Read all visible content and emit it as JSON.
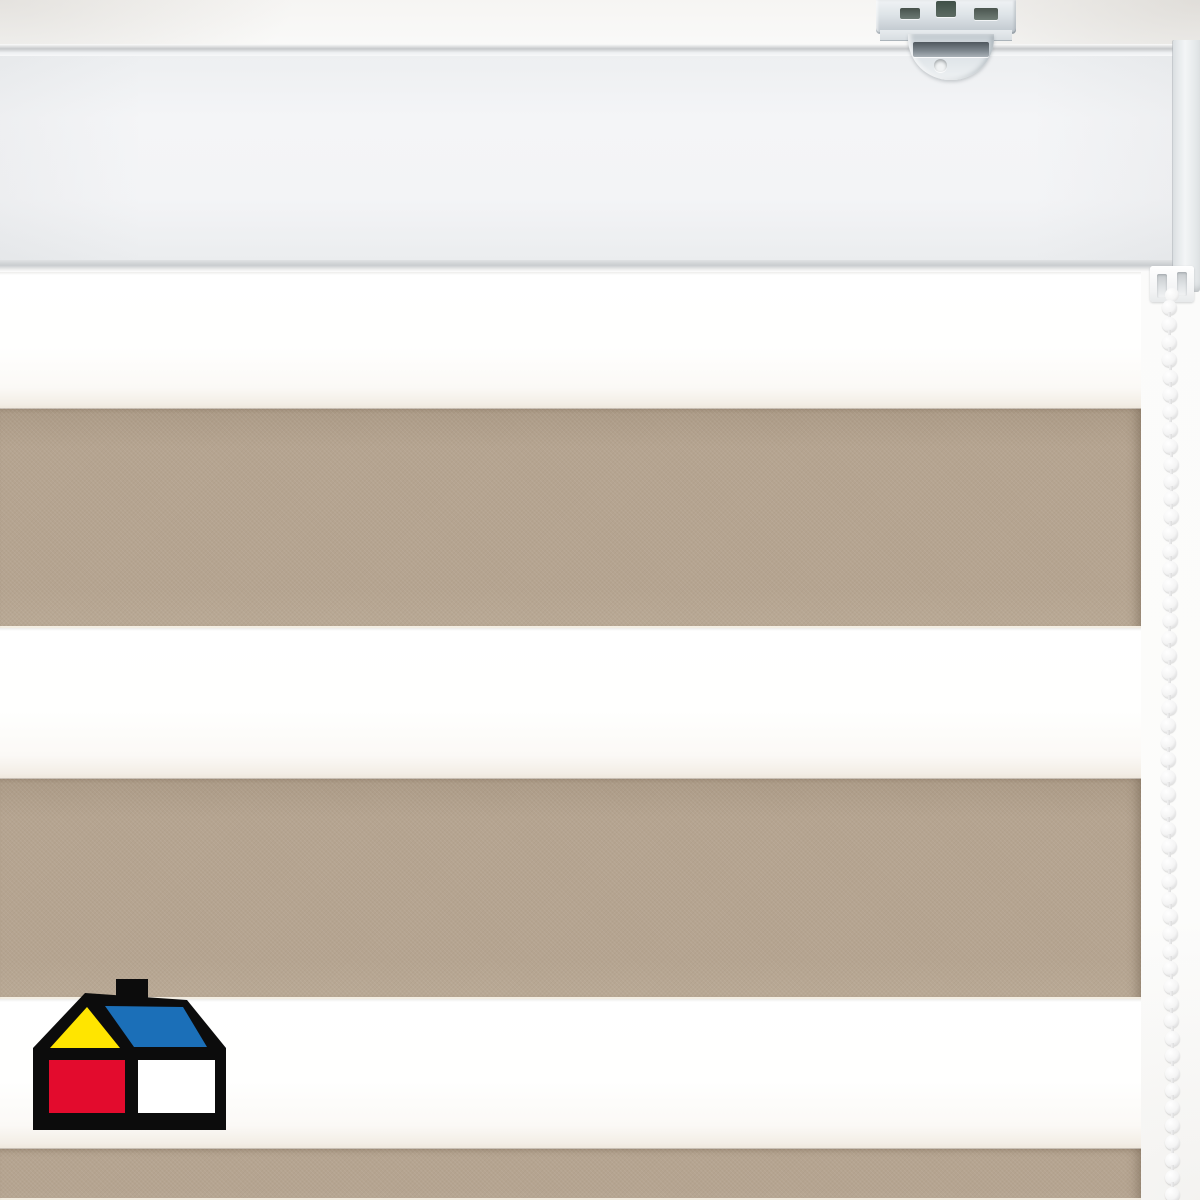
{
  "scene": {
    "kind": "product-photo",
    "subject": "day-night dual roller blind, closeup of white headrail, striped fabric, mounting bracket and pull chain"
  },
  "colors": {
    "wall": "#fafaf9",
    "taupe": "#b5a490",
    "taupe_dark": "#ab9a86",
    "taupe_light": "#b9a995",
    "rail_face": "#f3f4f6",
    "rail_edge": "#c9cccf",
    "bracket_metal": "#d6dce0",
    "chain": "#ffffff",
    "logo_black": "#0c0c0c",
    "logo_yellow": "#ffe500",
    "logo_blue": "#1b6fb8",
    "logo_red": "#e30b2d",
    "logo_white": "#ffffff"
  },
  "blind": {
    "headrail": {
      "top": 44,
      "height": 228,
      "endcap_left": 1173
    },
    "fabric": {
      "left": 0,
      "top": 272,
      "width": 1141,
      "height": 928,
      "stripes": [
        {
          "kind": "sheer",
          "top": 0,
          "height": 136
        },
        {
          "kind": "solid",
          "top": 136,
          "height": 220
        },
        {
          "kind": "sheer",
          "top": 356,
          "height": 150
        },
        {
          "kind": "solid",
          "top": 506,
          "height": 221
        },
        {
          "kind": "sheer",
          "top": 727,
          "height": 149
        },
        {
          "kind": "solid",
          "top": 876,
          "height": 52
        }
      ]
    },
    "chain": {
      "center_x": 1169,
      "start_y": 300,
      "spacing": 17.4,
      "bead_count": 52,
      "bead_size": 15
    }
  },
  "logo": {
    "colors": {
      "black": "#0c0c0c",
      "yellow": "#ffe500",
      "blue": "#1b6fb8",
      "red": "#e30b2d",
      "white": "#ffffff"
    },
    "shapes": {
      "chimney": {
        "x": 83,
        "y": 0,
        "w": 32,
        "h": 26
      },
      "outline_points": "0,69 52,14 154,21 193,69 193,151 0,151",
      "yellow_points": "54,28 17,69 87,69",
      "blue_points": "72,27 150,28 174,68 101,68",
      "red_rect": {
        "x": 16,
        "y": 81,
        "w": 76,
        "h": 53
      },
      "white_rect": {
        "x": 105,
        "y": 81,
        "w": 77,
        "h": 53
      }
    }
  }
}
